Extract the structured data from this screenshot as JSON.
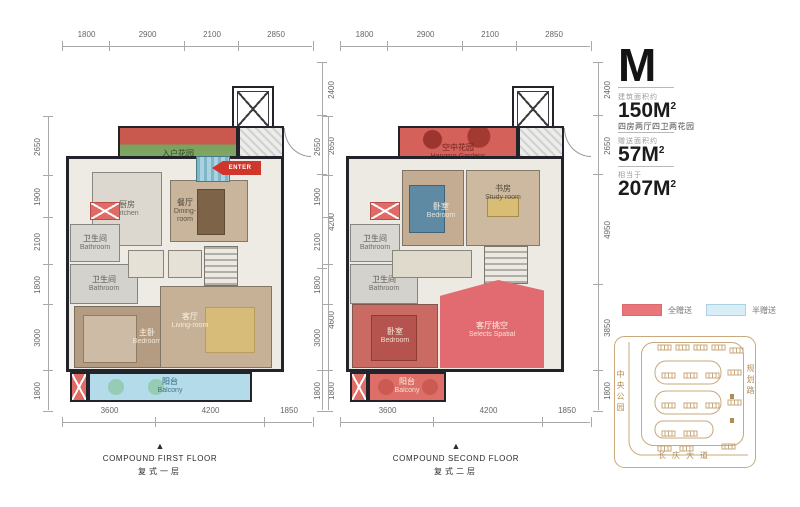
{
  "unit_panel": {
    "unit_name": "M",
    "sections": [
      {
        "label": "建筑面积约",
        "value": "150M",
        "sup": "2"
      },
      {
        "label": "赠送面积约",
        "value": "57M",
        "sup": "2"
      },
      {
        "label": "相当于",
        "value": "207M",
        "sup": "2"
      }
    ],
    "desc": "四房两厅四卫两花园",
    "legend": [
      {
        "label": "全赠送",
        "color": "#e8767b"
      },
      {
        "label": "半赠送",
        "color": "#d8edf6"
      }
    ],
    "siteplan": {
      "left_road": "中央公园",
      "right_road": "规划路",
      "bottom_road": "长庆大道"
    }
  },
  "colors": {
    "full_gift_fill": "#e26b72",
    "half_gift_fill": "#b3dbe9",
    "wall": "#23232b",
    "siteplan_gold": "#c8a87c"
  },
  "plans": [
    {
      "caption_en": "COMPOUND FIRST FLOOR",
      "caption_cn": "复式一层",
      "marker": "▲",
      "enter_label": "ENTER",
      "rooms": {
        "garden": {
          "cn": "入户花园",
          "en": "Home Garden"
        },
        "kitchen": {
          "cn": "厨房",
          "en": "Kitchen"
        },
        "dining": {
          "cn": "餐厅",
          "en": "Dining-room"
        },
        "bath1": {
          "cn": "卫生间",
          "en": "Bathroom"
        },
        "bath2": {
          "cn": "卫生间",
          "en": "Bathroom"
        },
        "master": {
          "cn": "主卧",
          "en": "Bedroom"
        },
        "living": {
          "cn": "客厅",
          "en": "Living-room"
        },
        "balcony": {
          "cn": "阳台",
          "en": "Balcony"
        }
      },
      "dims": {
        "top": [
          "1800",
          "2900",
          "2100",
          "2850"
        ],
        "left": [
          "2650",
          "1900",
          "2100",
          "1800",
          "3000",
          "1800"
        ],
        "right": [
          "2400",
          "2650",
          "4200",
          "4600",
          "1800"
        ],
        "bottom": [
          "3600",
          "4200",
          "1850"
        ]
      }
    },
    {
      "caption_en": "COMPOUND SECOND FLOOR",
      "caption_cn": "复式二层",
      "marker": "▲",
      "rooms": {
        "garden": {
          "cn": "空中花园",
          "en": "Hanging Gardens"
        },
        "bedroom": {
          "cn": "卧室",
          "en": "Bedroom"
        },
        "study": {
          "cn": "书房",
          "en": "Study room"
        },
        "bath1": {
          "cn": "卫生间",
          "en": "Bathroom"
        },
        "bath2": {
          "cn": "卫生间",
          "en": "Bathroom"
        },
        "void": {
          "cn": "客厅挑空",
          "en": "Selects Spatial"
        },
        "bedroom2": {
          "cn": "卧室",
          "en": "Bedroom"
        },
        "balcony": {
          "cn": "阳台",
          "en": "Balcony"
        }
      },
      "dims": {
        "top": [
          "1800",
          "2900",
          "2100",
          "2850"
        ],
        "left": [
          "2650",
          "1900",
          "2100",
          "1800",
          "3000",
          "1800"
        ],
        "right": [
          "2400",
          "2650",
          "4950",
          "3850",
          "1800"
        ],
        "bottom": [
          "3600",
          "4200",
          "1850"
        ]
      }
    }
  ]
}
